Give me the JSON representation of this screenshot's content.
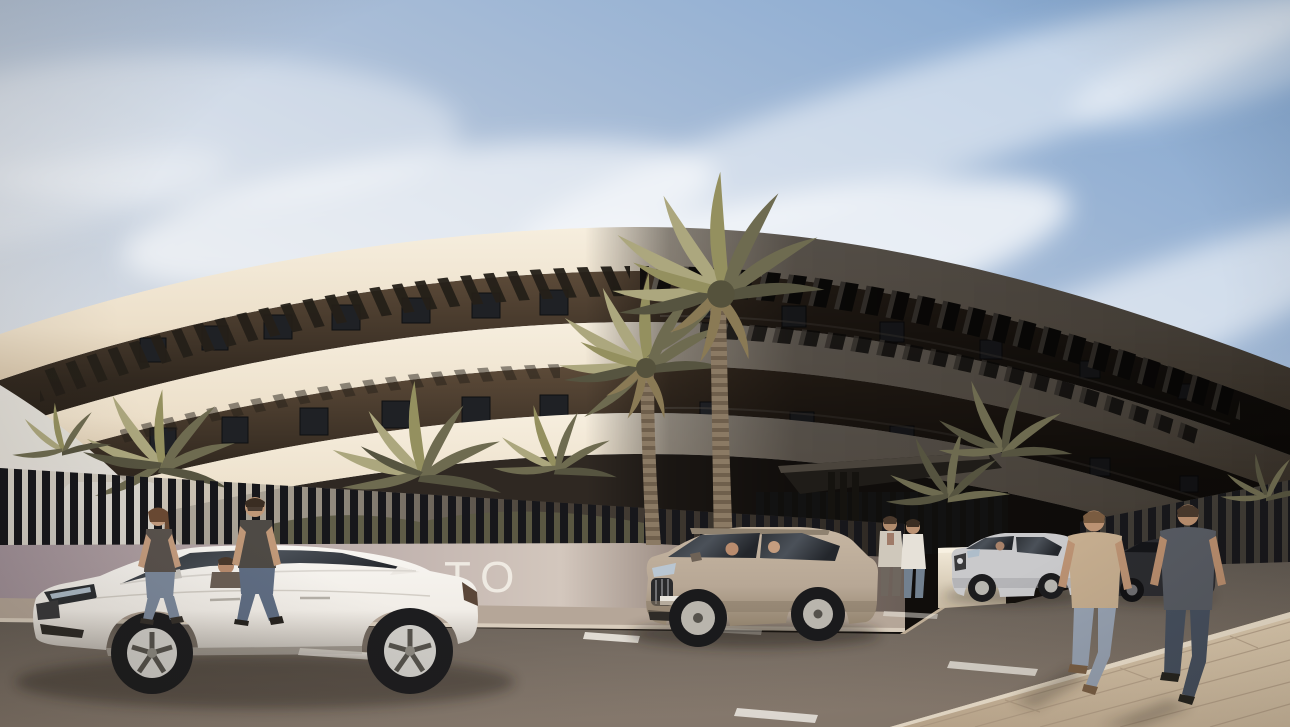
{
  "meta": {
    "title": "Modern curved apartment building exterior render",
    "description": "Sunny architectural visualization: a three-storey curved white apartment building with dark louvred pergolas and recessed balconies, date palms, a slatted boundary fence, four cars on the street and six pedestrians.",
    "time_of_day": "daytime",
    "weather": "sunny with wispy cirrus clouds"
  },
  "signage": {
    "partial_text": "TO"
  },
  "palette": {
    "sky_top": "#7fa4cf",
    "sky_horizon": "#e9e6e1",
    "cloud": "#ffffff",
    "facade_sunlit": "#efe5d2",
    "facade_shadow": "#5a544e",
    "balcony_recess": "#2a221b",
    "pergola_slat": "#241f18",
    "fence_slat": "#17171b",
    "boundary_wall": "#a2929a",
    "road_asphalt": "#6e655c",
    "sidewalk_paving": "#d2bfa4",
    "lane_marking": "#ece8e0",
    "palm_frond_light": "#aca77e",
    "palm_frond_dark": "#6e6b50",
    "palm_trunk": "#8b7a64",
    "car_white": "#f4f1ec",
    "car_champagne": "#b7a795",
    "car_silver": "#c9c9cb",
    "car_dark": "#2b2c30"
  },
  "scene": {
    "building": {
      "label": "curved three-storey apartment building, sunlit left side, shadowed right side",
      "storeys_visible": 3
    },
    "entrance": {
      "label": "dark cantilevered entrance canopy with two visitors"
    },
    "vehicles": [
      {
        "label": "white sedan driving left, driver visible"
      },
      {
        "label": "champagne SUV with two occupants"
      },
      {
        "label": "silver sedan with driver"
      },
      {
        "label": "dark grey sedan parked at right"
      }
    ],
    "people": [
      {
        "label": "woman walking left in dark tee and jeans"
      },
      {
        "label": "man walking left in dark tee and jeans"
      },
      {
        "label": "visitor standing at entrance in light jacket"
      },
      {
        "label": "visitor standing at entrance in white top"
      },
      {
        "label": "man walking away in tan tee"
      },
      {
        "label": "man walking away in slate tee"
      }
    ],
    "vegetation": [
      {
        "label": "two tall date palms in front of facade"
      },
      {
        "label": "palm cluster behind left fence"
      },
      {
        "label": "palms flanking the entrance"
      }
    ]
  }
}
